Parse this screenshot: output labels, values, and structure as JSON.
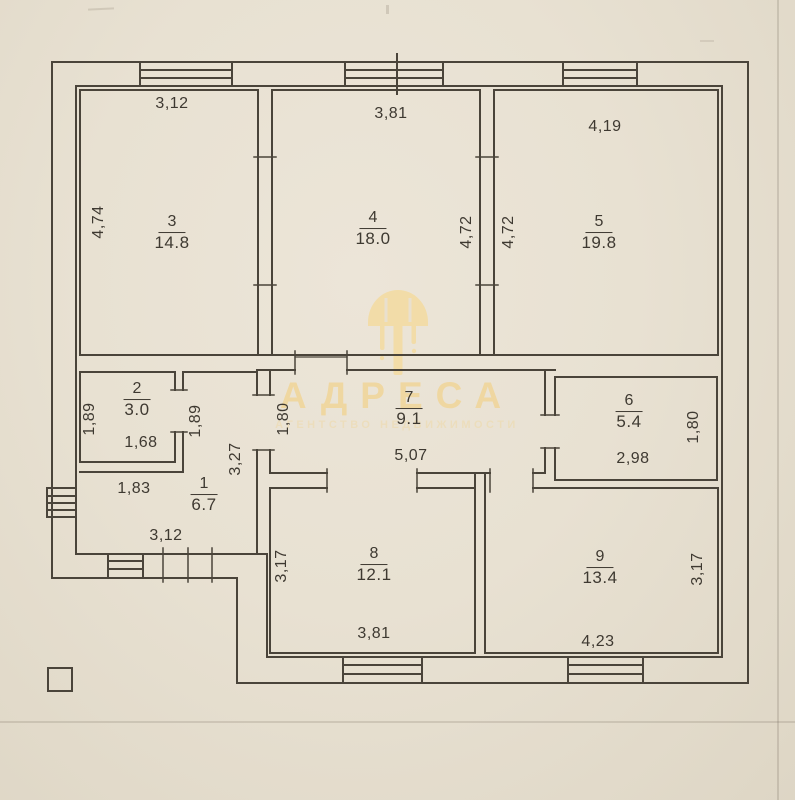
{
  "watermark": {
    "title": "АДРЕСА",
    "subtitle": "АГЕНТСТВО НЕДВИЖИМОСТИ",
    "color": "#f0d69d"
  },
  "plan": {
    "rooms": [
      {
        "number": "3",
        "area": "14.8",
        "x": 172,
        "y": 233
      },
      {
        "number": "4",
        "area": "18.0",
        "x": 373,
        "y": 229
      },
      {
        "number": "5",
        "area": "19.8",
        "x": 599,
        "y": 233
      },
      {
        "number": "2",
        "area": "3.0",
        "x": 137,
        "y": 400
      },
      {
        "number": "7",
        "area": "9.1",
        "x": 409,
        "y": 409
      },
      {
        "number": "6",
        "area": "5.4",
        "x": 629,
        "y": 412
      },
      {
        "number": "1",
        "area": "6.7",
        "x": 204,
        "y": 495
      },
      {
        "number": "8",
        "area": "12.1",
        "x": 374,
        "y": 565
      },
      {
        "number": "9",
        "area": "13.4",
        "x": 600,
        "y": 568
      }
    ],
    "dimensions": [
      {
        "value": "3,12",
        "x": 172,
        "y": 104,
        "rot": 0
      },
      {
        "value": "4,74",
        "x": 99,
        "y": 222,
        "rot": 1
      },
      {
        "value": "3,81",
        "x": 391,
        "y": 114,
        "rot": 0
      },
      {
        "value": "4,72",
        "x": 467,
        "y": 232,
        "rot": 1
      },
      {
        "value": "4,72",
        "x": 509,
        "y": 232,
        "rot": 1
      },
      {
        "value": "4,19",
        "x": 605,
        "y": 127,
        "rot": 0
      },
      {
        "value": "1,89",
        "x": 90,
        "y": 419,
        "rot": 1
      },
      {
        "value": "1,89",
        "x": 196,
        "y": 421,
        "rot": 1
      },
      {
        "value": "1,68",
        "x": 141,
        "y": 443,
        "rot": 0
      },
      {
        "value": "1,83",
        "x": 134,
        "y": 489,
        "rot": 0
      },
      {
        "value": "3,27",
        "x": 236,
        "y": 459,
        "rot": 1
      },
      {
        "value": "1,80",
        "x": 284,
        "y": 419,
        "rot": 1
      },
      {
        "value": "5,07",
        "x": 411,
        "y": 456,
        "rot": 0
      },
      {
        "value": "2,98",
        "x": 633,
        "y": 459,
        "rot": 0
      },
      {
        "value": "1,80",
        "x": 694,
        "y": 427,
        "rot": 1
      },
      {
        "value": "3,12",
        "x": 166,
        "y": 536,
        "rot": 0
      },
      {
        "value": "3,17",
        "x": 282,
        "y": 566,
        "rot": 1
      },
      {
        "value": "3,81",
        "x": 374,
        "y": 634,
        "rot": 0
      },
      {
        "value": "3,17",
        "x": 698,
        "y": 569,
        "rot": 1
      },
      {
        "value": "4,23",
        "x": 598,
        "y": 642,
        "rot": 0
      }
    ]
  }
}
